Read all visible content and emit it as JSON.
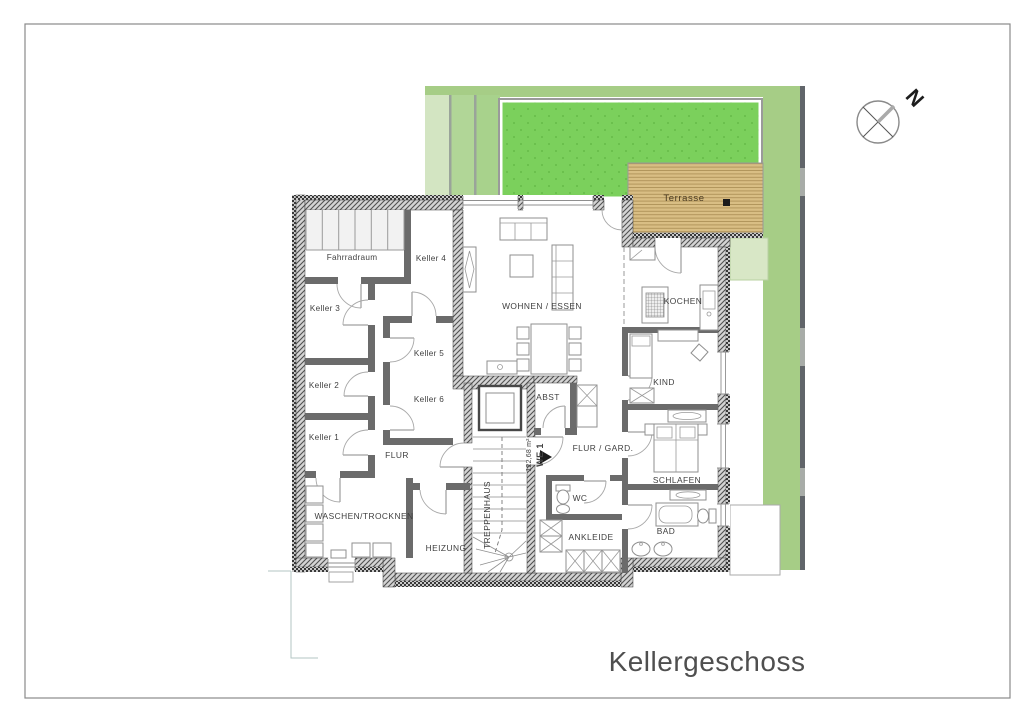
{
  "page": {
    "title": "Kellergeschoss"
  },
  "compass": {
    "north_label": "N"
  },
  "site": {
    "terrace_label": "Terrasse"
  },
  "apartment": {
    "area_label": "122,68 m²",
    "unit_label": "WE 1"
  },
  "rooms": {
    "fahrradraum": "Fahrradraum",
    "keller1": "Keller 1",
    "keller2": "Keller 2",
    "keller3": "Keller 3",
    "keller4": "Keller 4",
    "keller5": "Keller 5",
    "keller6": "Keller 6",
    "flur": "FLUR",
    "waschen_trocknen": "WASCHEN/TROCKNEN",
    "heizung": "HEIZUNG",
    "treppenhaus": "TREPPENHAUS",
    "abst": "ABST",
    "wohnen_essen": "WOHNEN / ESSEN",
    "kochen": "KOCHEN",
    "kind": "KIND",
    "flur_gard": "FLUR / GARD.",
    "schlafen": "SCHLAFEN",
    "wc": "WC",
    "ankleide": "ANKLEIDE",
    "bad": "BAD"
  },
  "colors": {
    "lawn": "#7bd05c",
    "garden": "#a6cd86",
    "garden_band_light": "#d3e5c2",
    "garden_band_mid": "#b1d697",
    "garden_pale_patch": "#d8e7c6",
    "terrace_wood": "#d9be84",
    "wall_interior": "#6b6b6b",
    "hatch_background": "#d4d4d4",
    "label_text": "#3f3f3f",
    "title_text": "#4f4f4f"
  }
}
